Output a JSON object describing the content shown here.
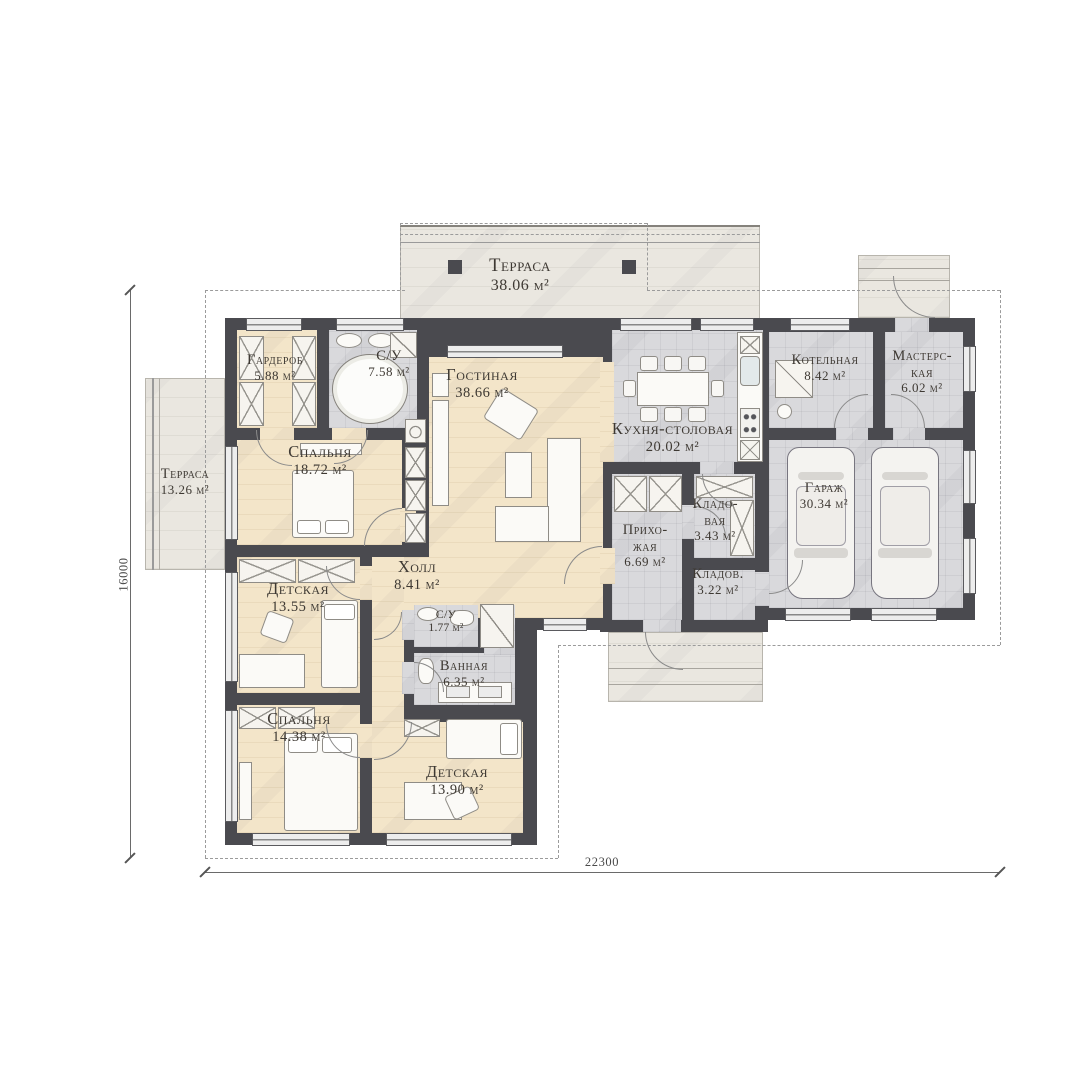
{
  "plan_type": "floor-plan",
  "rooms": [
    {
      "name": "Терраса",
      "area": "38.06 м²"
    },
    {
      "name": "Терраса",
      "area": "13.26 м²"
    },
    {
      "name": "Гарде­роб",
      "area": "5.88 м²"
    },
    {
      "name": "С/У",
      "area": "7.58 м²"
    },
    {
      "name": "Спальня",
      "area": "18.72 м²"
    },
    {
      "name": "Гостиная",
      "area": "38.66 м²"
    },
    {
      "name": "Кухня-столовая",
      "area": "20.02 м²"
    },
    {
      "name": "Котельная",
      "area": "8.42 м²"
    },
    {
      "name": "Мастерс­кая",
      "area": "6.02 м²"
    },
    {
      "name": "Гараж",
      "area": "30.34 м²"
    },
    {
      "name": "Кладо­вая",
      "area": "3.43 м²"
    },
    {
      "name": "Прихо­жая",
      "area": "6.69 м²"
    },
    {
      "name": "Кладов.",
      "area": "3.22 м²"
    },
    {
      "name": "Холл",
      "area": "8.41 м²"
    },
    {
      "name": "Детская",
      "area": "13.55 м²"
    },
    {
      "name": "С/У",
      "area": "1.77 м²"
    },
    {
      "name": "Ванная",
      "area": "6.35 м²"
    },
    {
      "name": "Спальня",
      "area": "14.38 м²"
    },
    {
      "name": "Детская",
      "area": "13.90 м²"
    }
  ],
  "dimensions": {
    "width_label": "22300",
    "height_label": "16000"
  },
  "colors": {
    "wall": "#4a4a4f",
    "floor_warm": "#f3e5c9",
    "floor_tile": "#d9d9dc",
    "terrace": "#eae7e0",
    "text": "#3e3933"
  }
}
